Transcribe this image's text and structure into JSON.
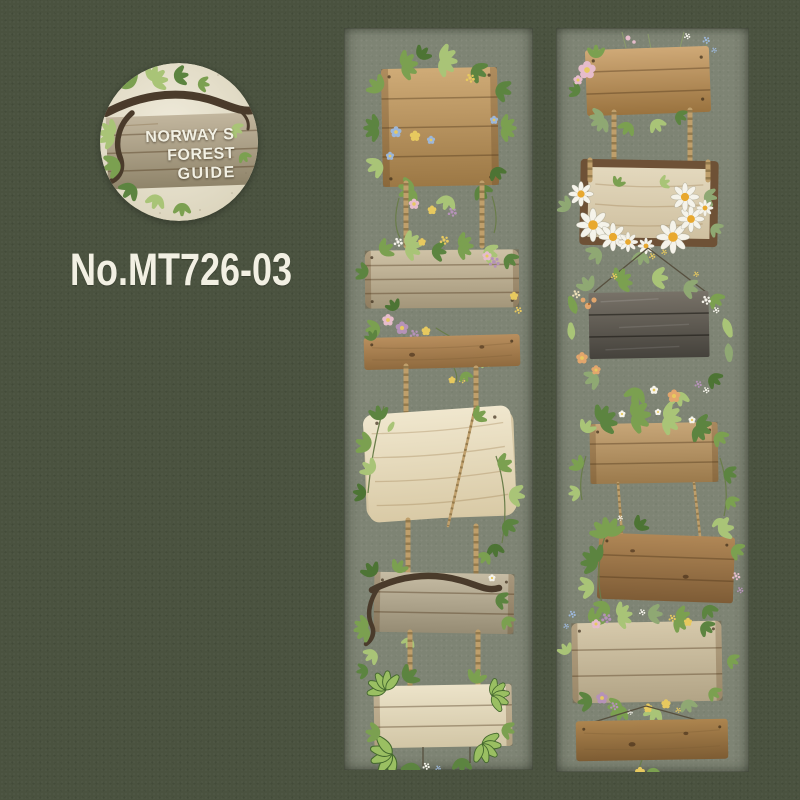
{
  "badge": {
    "line1": "NORWAY S",
    "line2": "FOREST",
    "line3": "GUIDE",
    "alt": "Circular brand badge: watercolor wooden sign with dark branch and green leaves on cream paper"
  },
  "product_number": "No.MT726-03",
  "strips": {
    "left": {
      "alt": "Washi tape strip sample with hanging wooden signs decorated with ivy, vines and small flowers",
      "signs": [
        "square tan plank sign wrapped in flowering vine",
        "wide weathered sign with flower garland",
        "narrow brown plank",
        "large pale wooden board with ivy and rope",
        "grey plank sign draped with dark branch",
        "pale plank sign with large ivy leaves"
      ]
    },
    "right": {
      "alt": "Washi tape strip sample with hanging wooden signs decorated with daisies, wildflowers and ivy",
      "signs": [
        "brown plank sign with pink flower and wildflowers",
        "framed pale sign with white daisies",
        "dark charcoal sign in wildflower wreath",
        "tan sign with ivy garland",
        "brown sign with ivy leaves",
        "weathered sign with flower garlands",
        "narrow brown plank with yellow sprig"
      ]
    }
  },
  "palette": {
    "background": "#4a523f",
    "strip": "#7e8474",
    "text": "#f2f0e3",
    "badge_paper": "#e9e4d1",
    "badge_wood": "#b3a78f",
    "branch": "#54432f",
    "rope": "#bf9f6b",
    "rope_dark": "#8a7045",
    "leaf_green": "#7ba050",
    "leaf_dark": "#4d7434",
    "leaf_light": "#a9c477",
    "leaf_sage": "#8fa873",
    "wood_tan": "#c8a572",
    "wood_pale": "#e7ddc2",
    "wood_gray": "#c3b9a2",
    "wood_brown": "#a8815a",
    "wood_charcoal": "#6e6961",
    "flower_pink": "#e6bccb",
    "flower_mauve": "#b592b8",
    "flower_yellow": "#e7c95f",
    "flower_blue": "#9cb6d8",
    "flower_white": "#f5f3ea",
    "flower_peach": "#e2a66d",
    "daisy_center": "#e8a82e"
  }
}
